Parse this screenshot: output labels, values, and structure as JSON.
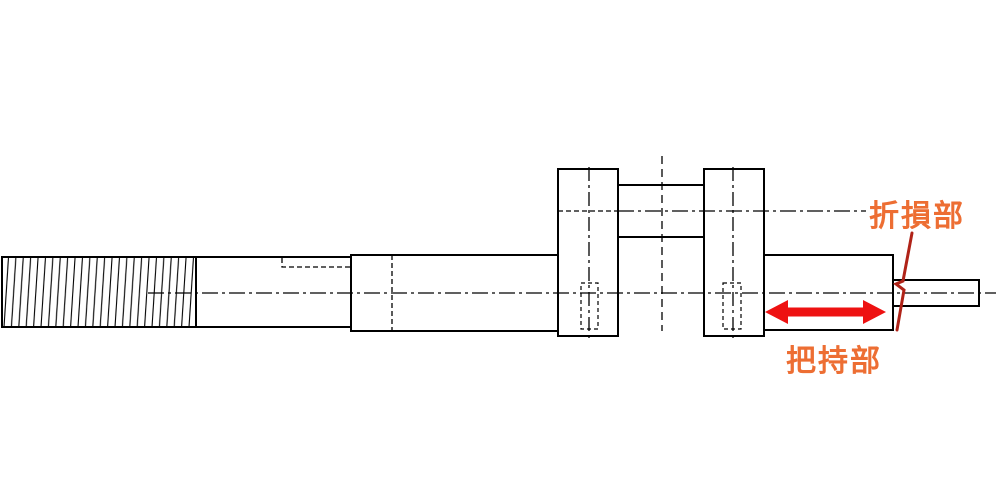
{
  "figure": {
    "title": "crankshaft fracture diagram",
    "labels": {
      "fracture": "折損部",
      "grip": "把持部"
    },
    "annotations": {
      "grip_arrow": "double-headed-arrow",
      "fracture_mark": "zigzag-fracture-line"
    },
    "colors": {
      "label_orange": "#ED6E33",
      "arrow_red": "#EE1111",
      "fracture_red": "#B02318",
      "line_black": "#000000",
      "background": "#FFFFFF"
    }
  }
}
